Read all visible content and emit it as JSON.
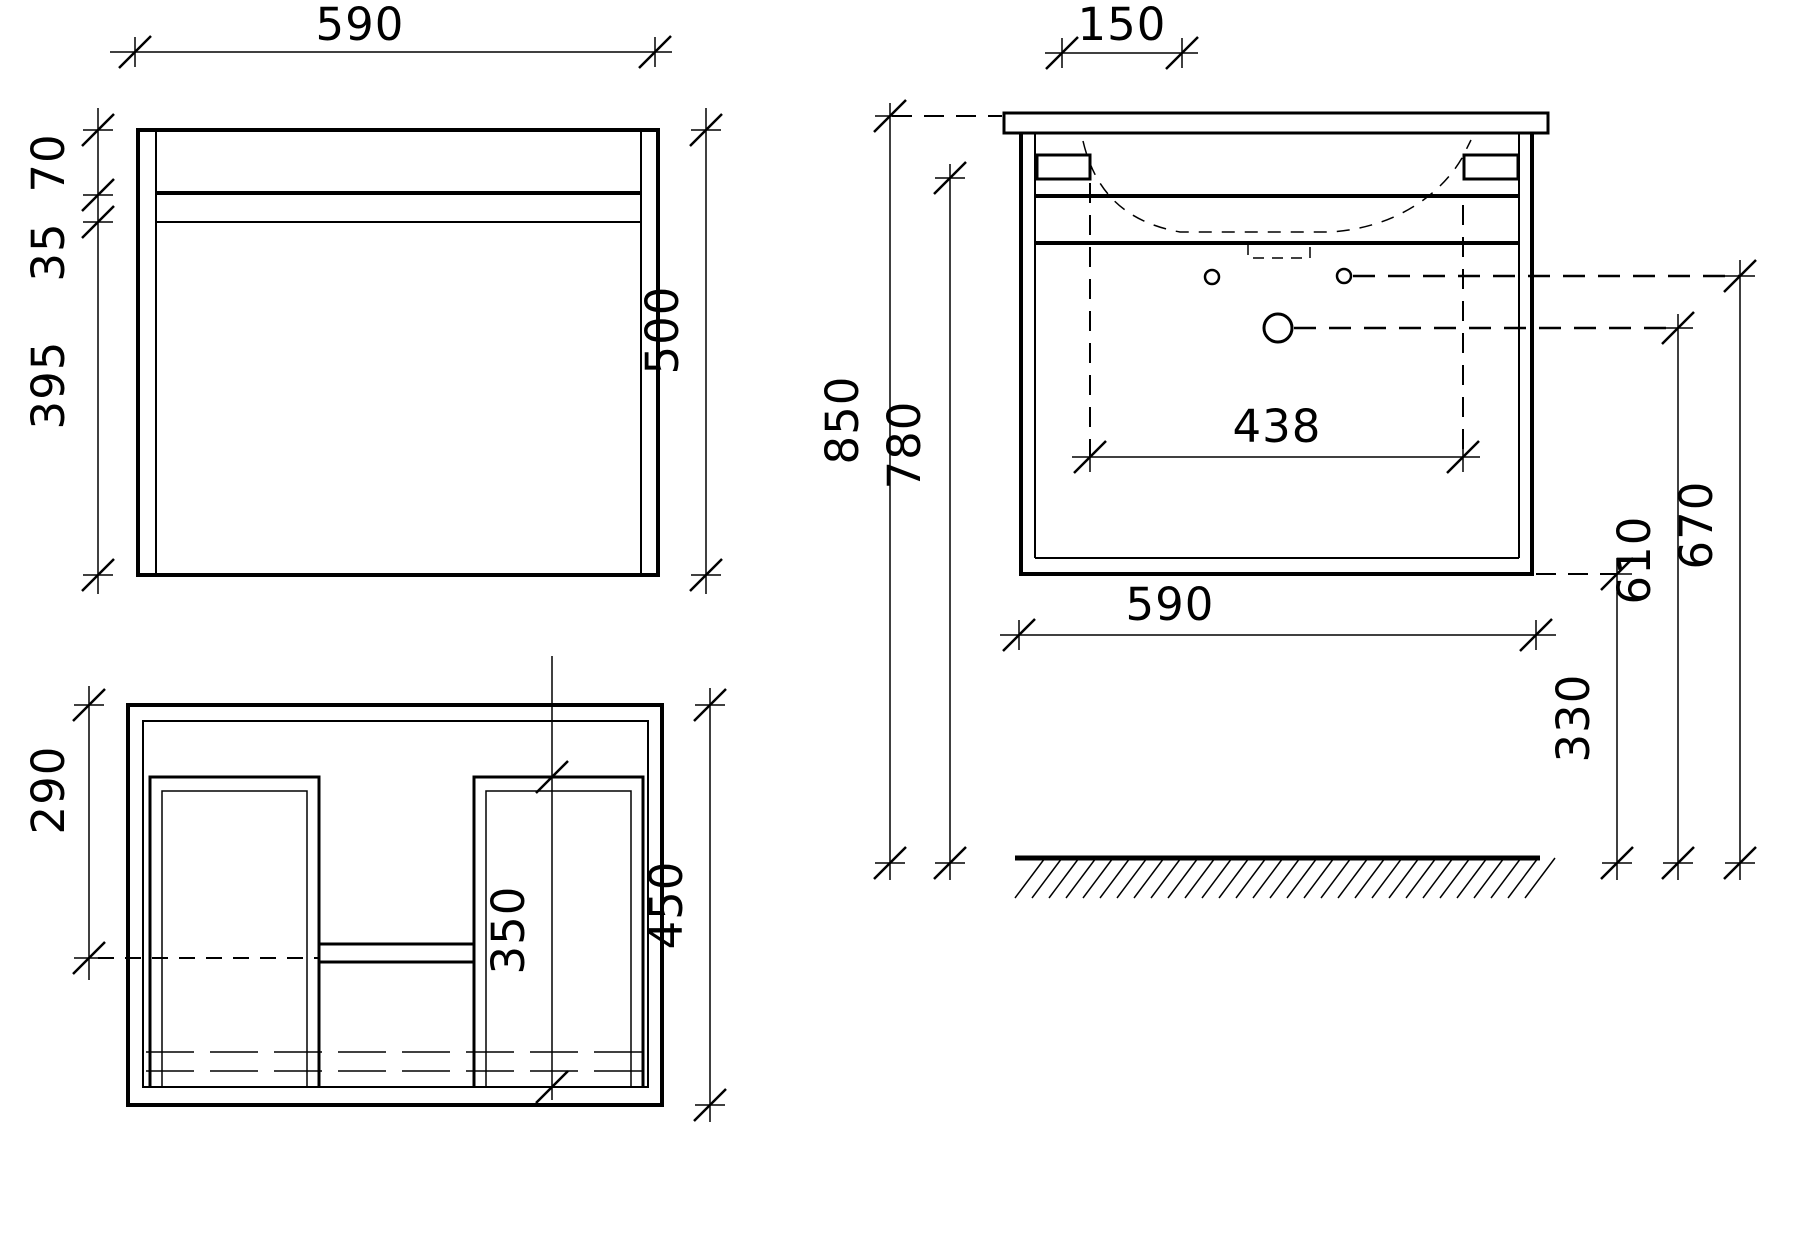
{
  "drawing": {
    "front_view": {
      "width": "590",
      "top_rail_height": "70",
      "rail_gap": "35",
      "lower_height": "395",
      "total_height": "500"
    },
    "plan_view": {
      "runner_setback": "290",
      "runner_length": "350",
      "depth": "450"
    },
    "side_view": {
      "tap_spacing": "150",
      "height_worktop": "850",
      "height_body_top": "780",
      "hole_span": "438",
      "depth": "590",
      "bottom_clearance": "330",
      "drain_height": "610",
      "supply_height": "670"
    }
  },
  "colors": {
    "line": "#000000",
    "background": "#ffffff"
  }
}
